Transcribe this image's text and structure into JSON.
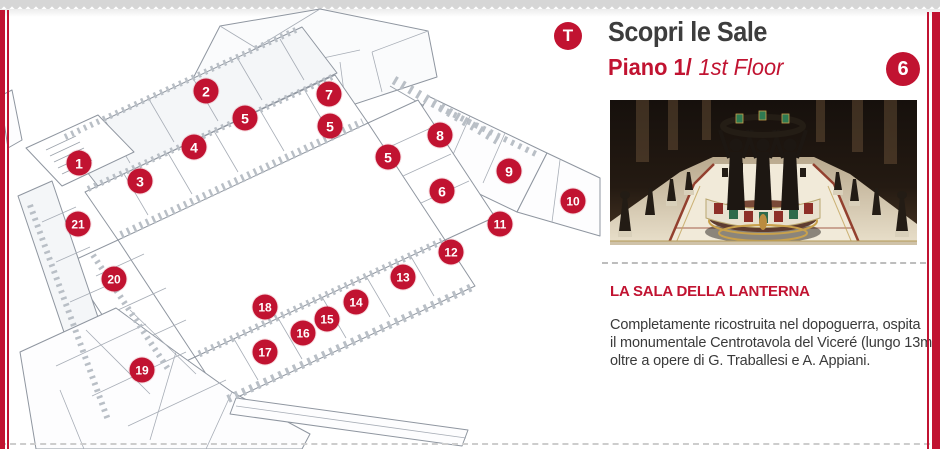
{
  "accent_red": "#c11331",
  "header": {
    "badge_t": "T",
    "title": "Scopri le Sale",
    "subtitle_bold": "Piano 1/",
    "subtitle_italic": "1st Floor",
    "room_badge": "6"
  },
  "article": {
    "heading": "LA SALA DELLA LANTERNA",
    "body_lines": [
      "Completamente ricostruita nel dopoguerra, ospita",
      "il monumentale Centrotavola del Viceré (lungo 13m)",
      "oltre a opere di G. Traballesi e A. Appiani."
    ]
  },
  "map": {
    "markers": [
      {
        "label": "1",
        "x": 79,
        "y": 163
      },
      {
        "label": "2",
        "x": 206,
        "y": 91
      },
      {
        "label": "3",
        "x": 140,
        "y": 181
      },
      {
        "label": "4",
        "x": 194,
        "y": 147
      },
      {
        "label": "5",
        "x": 245,
        "y": 118
      },
      {
        "label": "5",
        "x": 330,
        "y": 126
      },
      {
        "label": "5",
        "x": 388,
        "y": 157
      },
      {
        "label": "6",
        "x": 442,
        "y": 191
      },
      {
        "label": "7",
        "x": 329,
        "y": 94
      },
      {
        "label": "8",
        "x": 440,
        "y": 135
      },
      {
        "label": "9",
        "x": 509,
        "y": 171
      },
      {
        "label": "10",
        "x": 573,
        "y": 201
      },
      {
        "label": "11",
        "x": 500,
        "y": 224
      },
      {
        "label": "12",
        "x": 451,
        "y": 252
      },
      {
        "label": "13",
        "x": 403,
        "y": 277
      },
      {
        "label": "14",
        "x": 356,
        "y": 302
      },
      {
        "label": "15",
        "x": 327,
        "y": 319
      },
      {
        "label": "16",
        "x": 303,
        "y": 333
      },
      {
        "label": "17",
        "x": 265,
        "y": 352
      },
      {
        "label": "18",
        "x": 265,
        "y": 307
      },
      {
        "label": "19",
        "x": 142,
        "y": 370
      },
      {
        "label": "20",
        "x": 114,
        "y": 279
      },
      {
        "label": "21",
        "x": 78,
        "y": 224
      }
    ]
  }
}
